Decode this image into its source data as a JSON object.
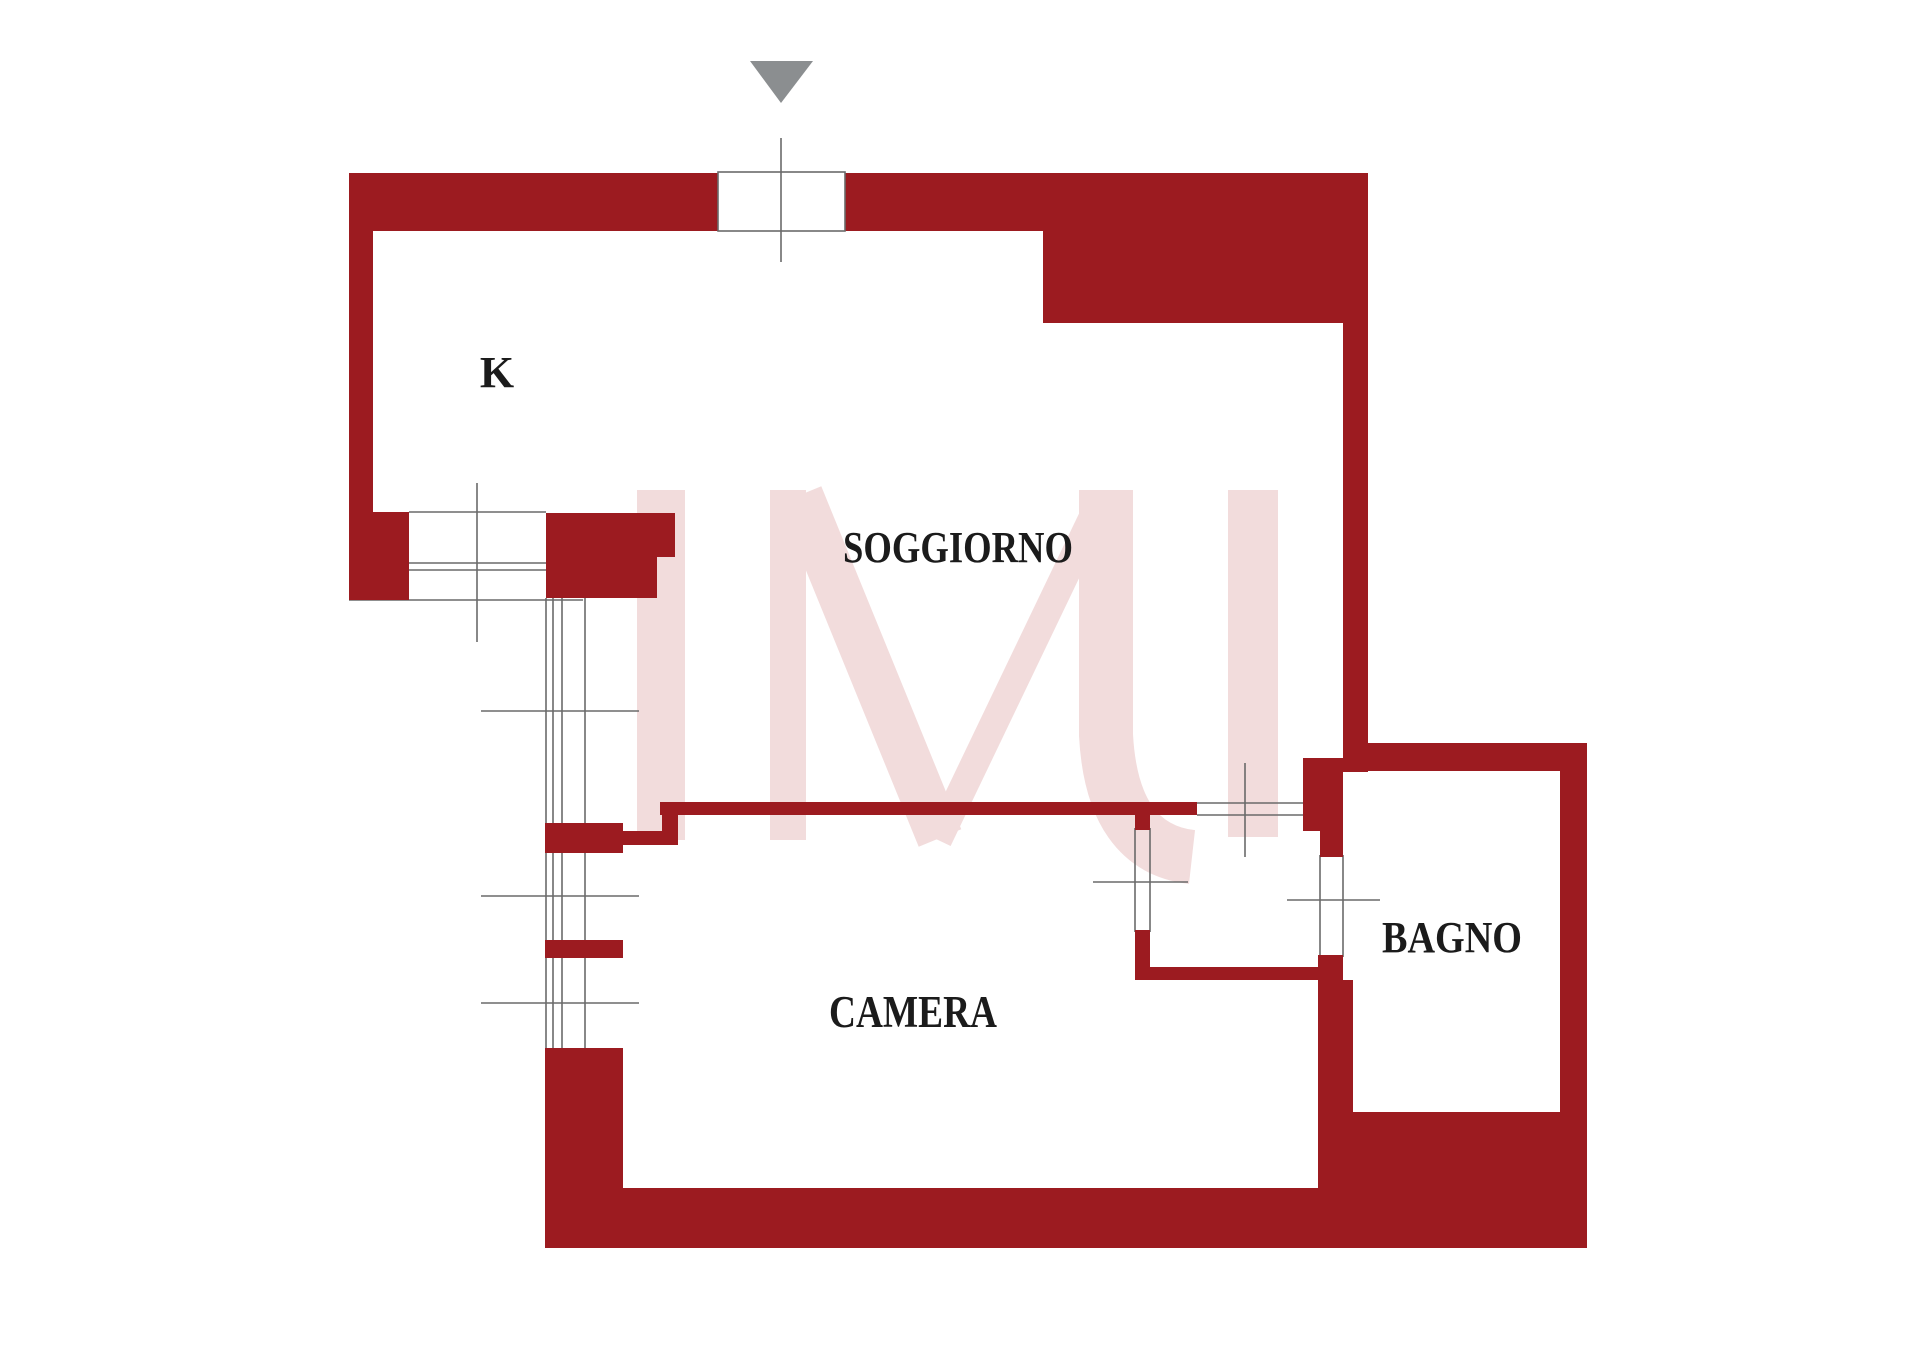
{
  "document": {
    "type": "floor-plan",
    "language": "it",
    "description": "Apartment floor plan with red walls, entrance arrow at top, watermark logo"
  },
  "colors": {
    "background": "#ffffff",
    "wall": "#9c1b20",
    "watermark": "#f2dcdc",
    "detail_line": "#6a6a6a",
    "entrance_arrow": "#8b8e90",
    "label_text": "#1b1b1b"
  },
  "watermark": {
    "text": "IMI"
  },
  "entrance": {
    "icon": "down-arrow"
  },
  "rooms": [
    {
      "id": "kitchen",
      "label": "K"
    },
    {
      "id": "soggiorno",
      "label": "SOGGIORNO"
    },
    {
      "id": "camera",
      "label": "CAMERA"
    },
    {
      "id": "bagno",
      "label": "BAGNO"
    }
  ]
}
